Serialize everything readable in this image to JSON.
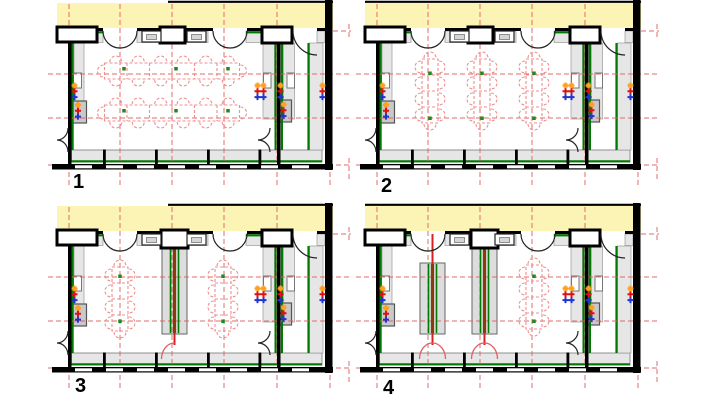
{
  "diagram": {
    "kind": "architectural-floor-plan-options",
    "options_count": 4
  },
  "colors": {
    "background": "#FFFFFF",
    "exterior_band": "#FBF4B5",
    "wall_black": "#000000",
    "heating_green": "#007A00",
    "grid_red": "#DE5F5F",
    "furniture_red": "#F08E8E",
    "partition_core": "#8A3A0E",
    "partition_red": "#D42020",
    "door_red": "#E06060",
    "fill_light": "#E6E6E6",
    "fill_mid": "#DDDDDD",
    "box_gray": "#C9C9C9",
    "border_gray": "#999999",
    "window_inner": "#D5D5D5",
    "table_green": "#1C8A1C",
    "marker_orange": "#FFA020",
    "marker_red": "#DD1111",
    "marker_blue": "#2233CC"
  },
  "panels": [
    {
      "label": "1",
      "tables": [
        {
          "orientation": "horizontal",
          "cx": 172,
          "cy": 71
        },
        {
          "orientation": "horizontal",
          "cx": 172,
          "cy": 113
        }
      ],
      "partitions": []
    },
    {
      "label": "2",
      "tables": [
        {
          "orientation": "vertical",
          "cx": 122,
          "cy": 91
        },
        {
          "orientation": "vertical",
          "cx": 174,
          "cy": 91
        },
        {
          "orientation": "vertical",
          "cx": 226,
          "cy": 91
        }
      ],
      "partitions": []
    },
    {
      "label": "3",
      "tables": [
        {
          "orientation": "vertical",
          "cx": 120,
          "cy": 96
        },
        {
          "orientation": "vertical",
          "cx": 223,
          "cy": 96
        }
      ],
      "partitions": [
        {
          "cx": 174.5,
          "attached_top": true,
          "door": "single"
        }
      ]
    },
    {
      "label": "4",
      "tables": [
        {
          "orientation": "vertical",
          "cx": 226,
          "cy": 94
        }
      ],
      "partitions": [
        {
          "cx": 124.5,
          "attached_top": false,
          "door": "double"
        },
        {
          "cx": 176.5,
          "attached_top": true,
          "door": "double"
        }
      ]
    }
  ]
}
